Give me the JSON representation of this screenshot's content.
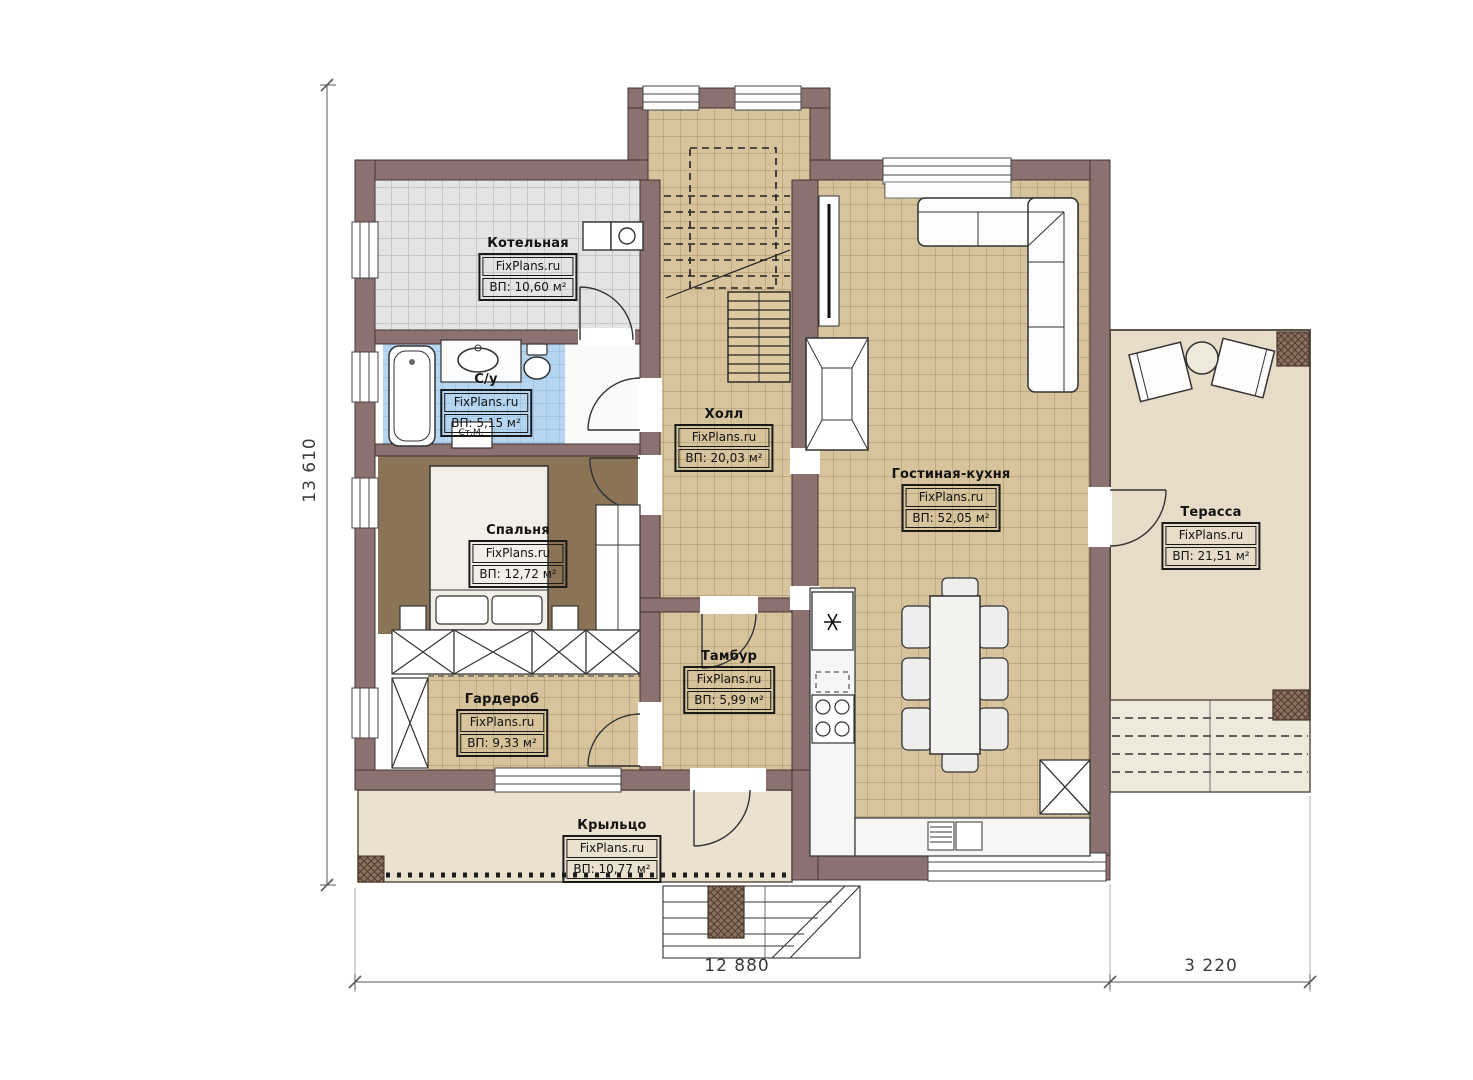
{
  "plan": {
    "watermark": "FixPlans.ru",
    "rooms": [
      {
        "id": "kotelnaya",
        "name": "Котельная",
        "area": "ВП: 10,60 м²"
      },
      {
        "id": "su",
        "name": "С/у",
        "area": "ВП: 5,15 м²"
      },
      {
        "id": "spalnya",
        "name": "Спальня",
        "area": "ВП: 12,72 м²"
      },
      {
        "id": "holl",
        "name": "Холл",
        "area": "ВП: 20,03 м²"
      },
      {
        "id": "gostinaya",
        "name": "Гостиная-кухня",
        "area": "ВП: 52,05 м²"
      },
      {
        "id": "tambur",
        "name": "Тамбур",
        "area": "ВП: 5,99 м²"
      },
      {
        "id": "garderob",
        "name": "Гардероб",
        "area": "ВП: 9,33 м²"
      },
      {
        "id": "kryltso",
        "name": "Крыльцо",
        "area": "ВП: 10,77 м²"
      },
      {
        "id": "terassa",
        "name": "Терасса",
        "area": "ВП: 21,51 м²"
      }
    ],
    "labels": {
      "washing_machine": "Ст.М."
    },
    "dimensions": {
      "height_total": "13 610",
      "width_main": "12 880",
      "width_terrace": "3 220"
    },
    "colors": {
      "wall": "#8c7171",
      "floor_tile_tan": "#d7c49c",
      "floor_tile_gray": "#e3e3e3",
      "floor_tile_blue": "#b5d5f0",
      "bedroom_floor": "#8b7355",
      "terrace_floor": "#e6dcc7",
      "porch_floor": "#eae1cf"
    }
  }
}
